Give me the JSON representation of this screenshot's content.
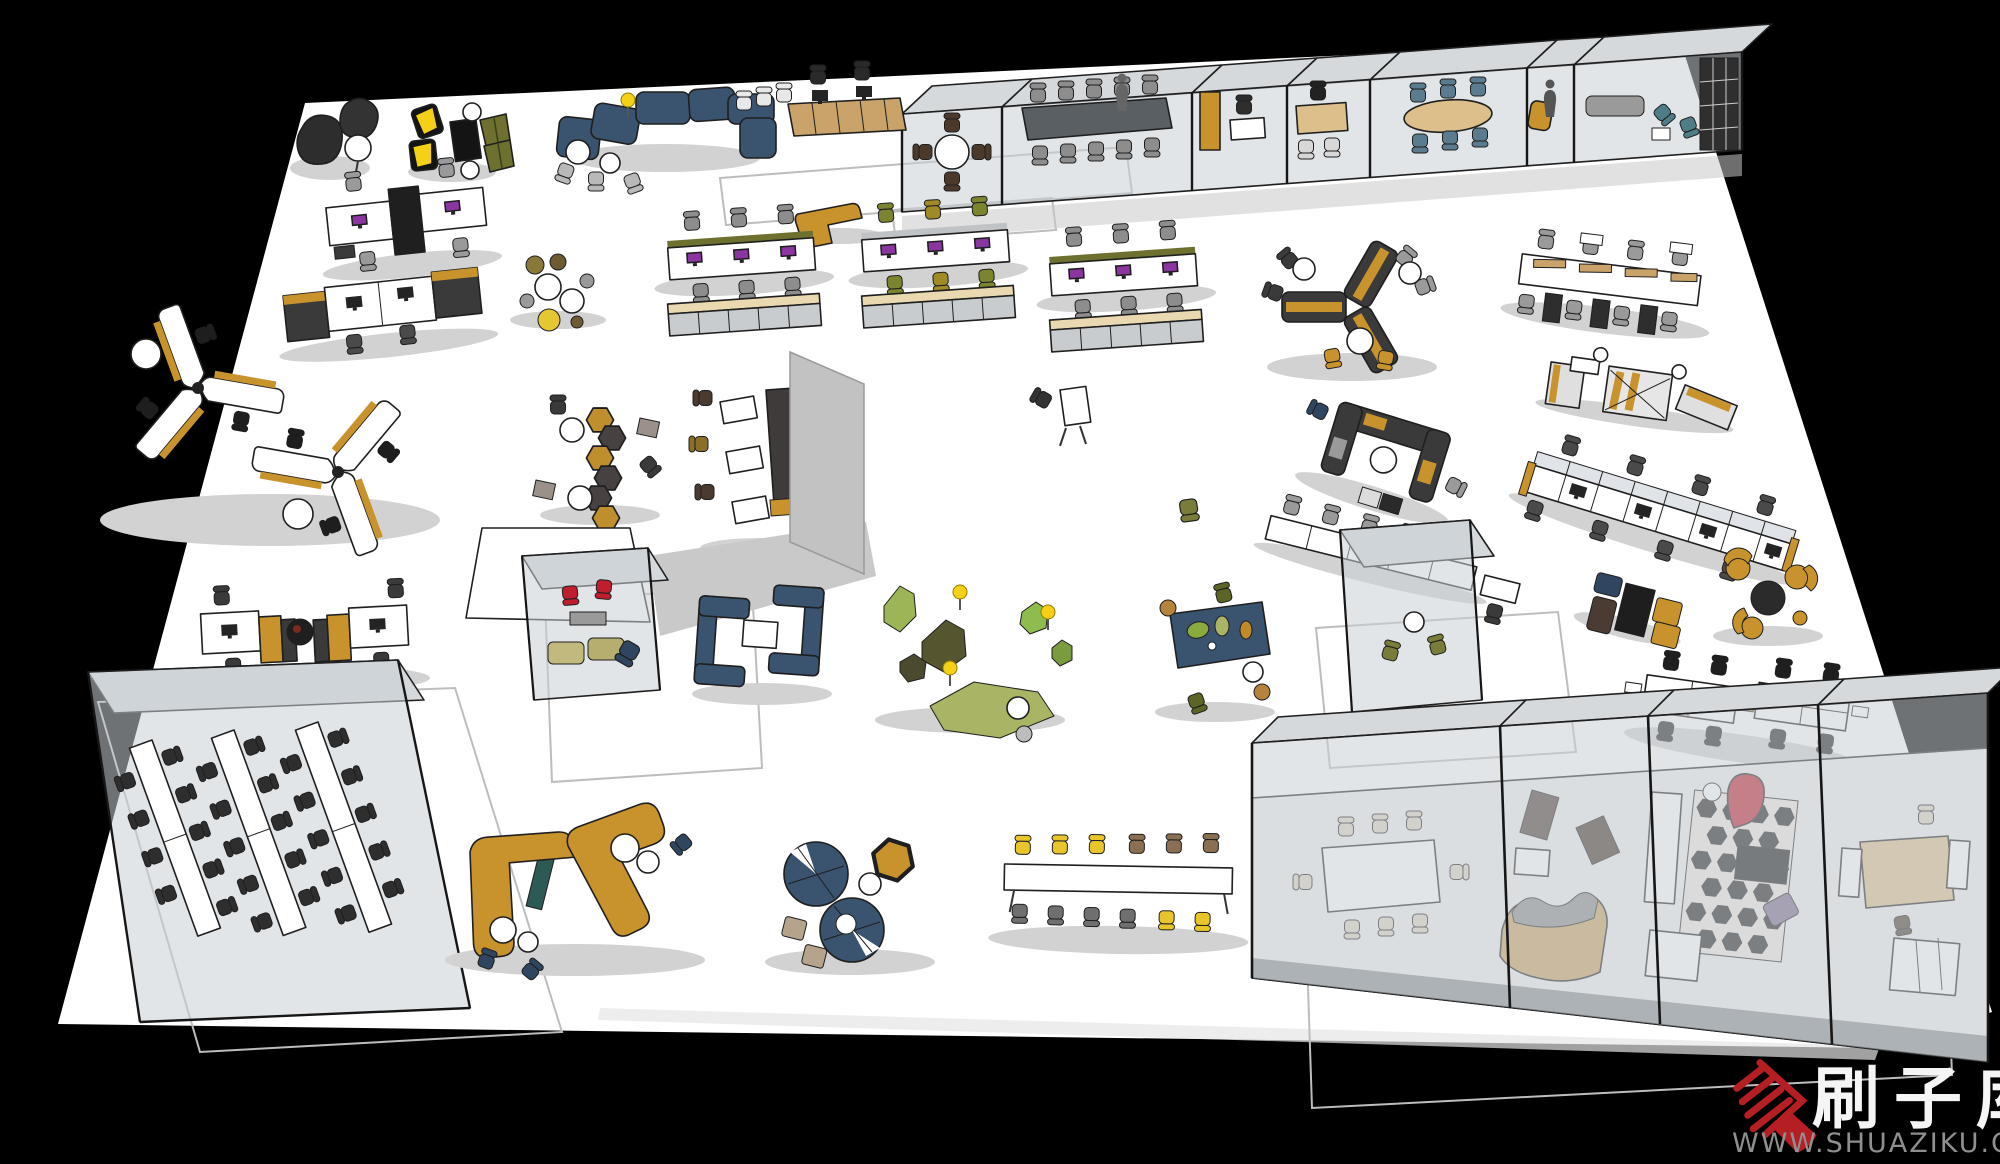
{
  "watermark": {
    "brand": "刷子库",
    "url": "WWW.SHUAZIKU.COM",
    "brand_color": "#f5f5f5",
    "url_color": "#8f8f8f",
    "logo_color": "#b51f24"
  },
  "scene": {
    "background": "#000000",
    "floor": "#ffffff",
    "outline": "#1f1f1f",
    "glass": "rgba(203,208,214,0.55)",
    "shadow": "#d2d2d2"
  },
  "palette": {
    "navy_blue": "#3a536f",
    "mustard": "#c8932d",
    "tan_wood": "#c9a36a",
    "locker_beige": "#ead9b0",
    "olive": "#6e7030",
    "olive_chair": "#7d8430",
    "charcoal": "#3a3a3a",
    "chair_gray": "#8d8d8d",
    "accent_red": "#bf1e2e",
    "light_wood": "#dcbf8a",
    "cream": "#ddd3c2",
    "monitor_purple": "#8b35a0",
    "stool_yellow": "#e8c52a",
    "moss_green_light": "#9cb557",
    "moss_green_dark": "#55552f",
    "moss_green_mid": "#a9b464",
    "steel_blue_chair": "#5b7b8e"
  },
  "zones": [
    {
      "name": "beanbag-lounge",
      "label": "Dark beanbag chairs with side table"
    },
    {
      "name": "yellow-lounge-chairs",
      "label": "Yellow sling chairs, black table, olive facet chairs"
    },
    {
      "name": "blue-modular-sofa",
      "label": "Navy S-shaped modular reception sofa"
    },
    {
      "name": "reception-credenza",
      "label": "Wooden credenza with two monitor desks"
    },
    {
      "name": "mustard-corner-bench",
      "label": "Mustard L-shaped bench"
    },
    {
      "name": "meeting-room-round-table",
      "label": "Glass room: round table, 4 chairs"
    },
    {
      "name": "boardroom",
      "label": "Glass boardroom: long dark table, 10 chairs"
    },
    {
      "name": "office-cabinet-room",
      "label": "Glass room: mustard cabinet and desk"
    },
    {
      "name": "private-office",
      "label": "Glass room: wooden desk office"
    },
    {
      "name": "oval-meeting-room",
      "label": "Glass room: oval table, blue chairs"
    },
    {
      "name": "phone-nook",
      "label": "Glass nook: mustard chair, standing figure"
    },
    {
      "name": "lounge-room-bookshelf",
      "label": "Glass lounge with bookshelf"
    },
    {
      "name": "workstation-pod-a",
      "label": "Back-to-back desks with storage spine"
    },
    {
      "name": "workstation-pod-b",
      "label": "Desk pair flanked by dark cabinets"
    },
    {
      "name": "workstation-row-1",
      "label": "3-seat bench desks + lockers, gray chairs"
    },
    {
      "name": "workstation-row-2",
      "label": "3-seat bench desks + lockers, olive chairs"
    },
    {
      "name": "workstation-row-3",
      "label": "3-seat bench desks + lockers"
    },
    {
      "name": "cafe-stools",
      "label": "Round tables with mixed stools"
    },
    {
      "name": "pinwheel-workstations",
      "label": "Two pinwheel desk clusters"
    },
    {
      "name": "hex-stool-chain",
      "label": "Hexagonal stool chain with tables"
    },
    {
      "name": "study-tables-partition",
      "label": "White tables, dark chairs, tall partition"
    },
    {
      "name": "presentation-screen",
      "label": "Freestanding white screen with gray wall"
    },
    {
      "name": "y-booth",
      "label": "Y-shaped charcoal booth, mustard trim"
    },
    {
      "name": "u-booth",
      "label": "U-shaped charcoal booth"
    },
    {
      "name": "desk-cluster-right",
      "label": "4-bay desks with storage towers"
    },
    {
      "name": "standing-tables",
      "label": "Standing tables with mustard rails"
    },
    {
      "name": "cubicle-row",
      "label": "Divider cubicle workstation row"
    },
    {
      "name": "counter-row",
      "label": "White counter row with chairs"
    },
    {
      "name": "training-room",
      "label": "Glass training room, 3 table rows"
    },
    {
      "name": "focus-cube-red",
      "label": "Glass cube: red chairs, olive sofa"
    },
    {
      "name": "focus-cube-olive",
      "label": "Glass cube: olive armchairs"
    },
    {
      "name": "blue-phone-booths",
      "label": "Navy high-back booths with table"
    },
    {
      "name": "moss-seating",
      "label": "Organic moss seats with ball lamps"
    },
    {
      "name": "planter-table",
      "label": "Navy planter table with olive chairs"
    },
    {
      "name": "desk-pairs",
      "label": "Desk pairs with mustard cabinets"
    },
    {
      "name": "mustard-sofa-lounge",
      "label": "Mustard L-sofas with navy tub chairs"
    },
    {
      "name": "circle-sofa",
      "label": "Navy figure-8 circular sofa, hex table"
    },
    {
      "name": "canteen-bar-table",
      "label": "Long bar table, yellow and gray chairs"
    },
    {
      "name": "ottoman-cluster",
      "label": "Ottomans, black table, mustard bench"
    },
    {
      "name": "mustard-tub-chairs",
      "label": "Mustard tub chairs, round table"
    },
    {
      "name": "quad-desk-cluster",
      "label": "Quad white desks, black chairs"
    },
    {
      "name": "conference-room",
      "label": "Glass room: white table, cream chairs"
    },
    {
      "name": "lounge-suite-room",
      "label": "Glass room: curved sofa suite"
    },
    {
      "name": "rug-lounge-room",
      "label": "Glass room: diamond rug, red chair"
    },
    {
      "name": "dining-room",
      "label": "Glass room: wooden dining table"
    }
  ]
}
